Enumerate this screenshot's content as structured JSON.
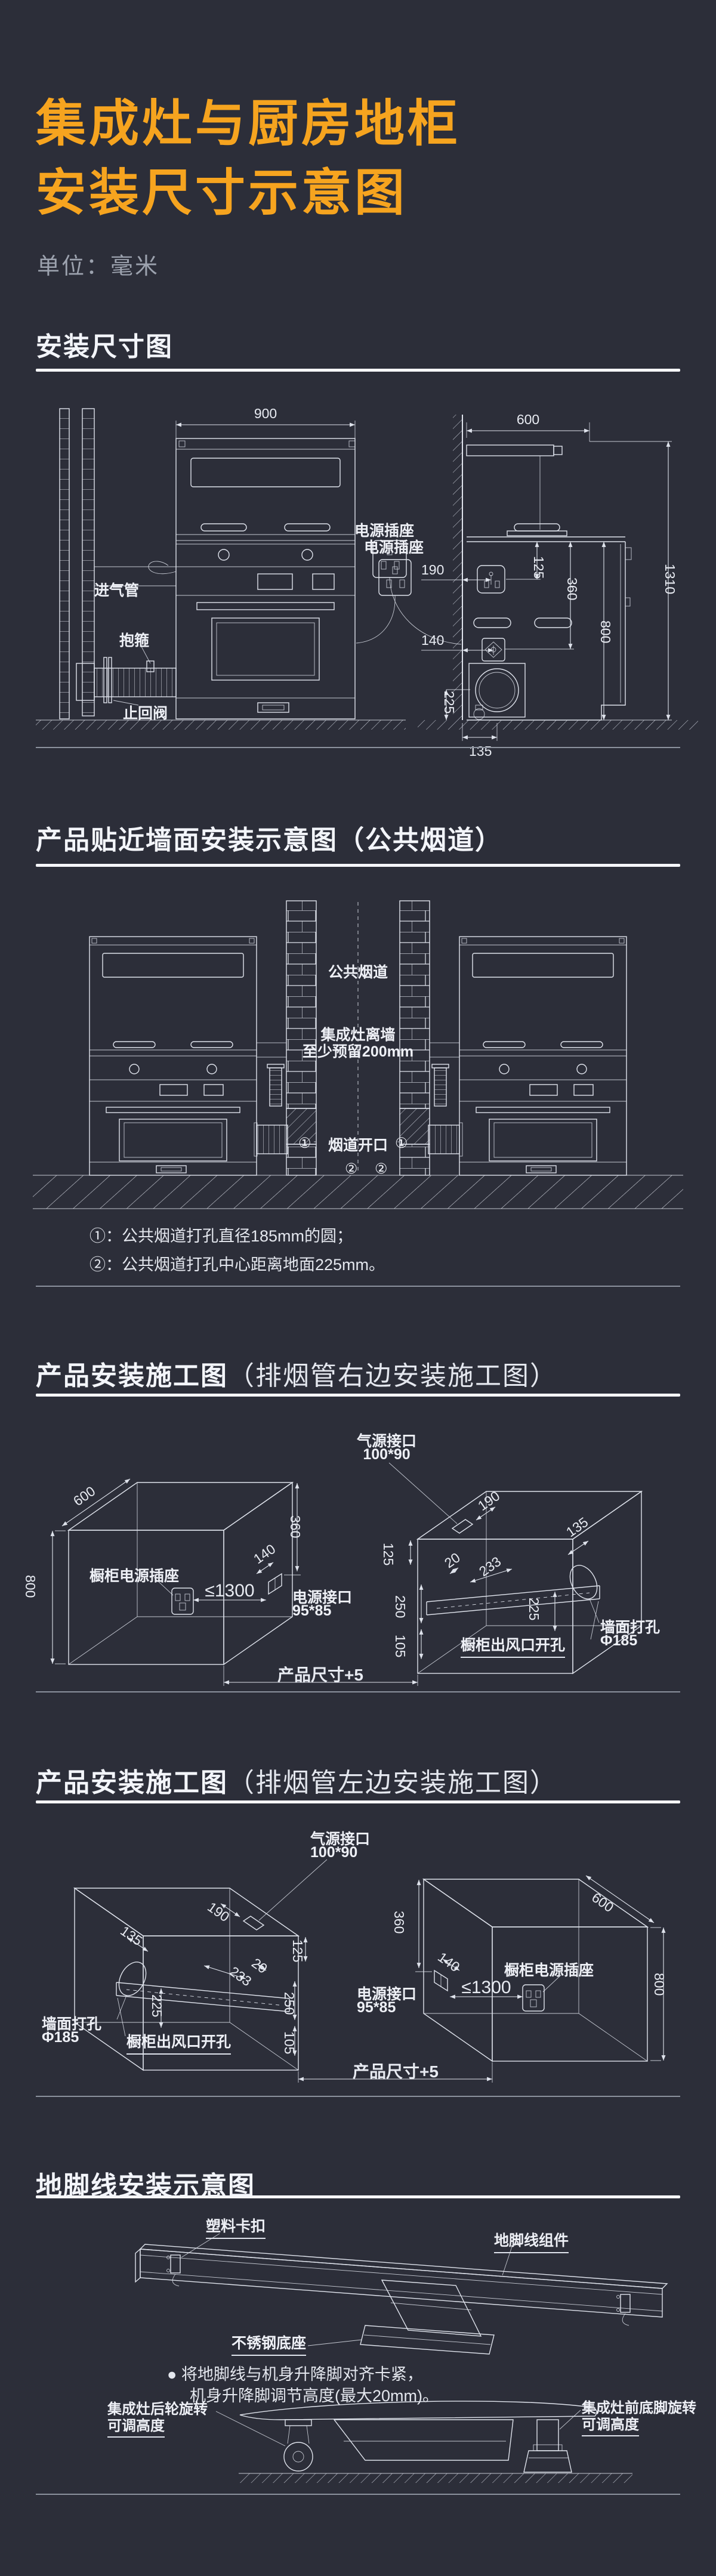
{
  "header": {
    "title_line1": "集成灶与厨房地柜",
    "title_line2": "安装尺寸示意图",
    "unit_note": "单位：毫米"
  },
  "colors": {
    "background": "#2c2e39",
    "accent_orange": "#f6a41f",
    "line": "#dfe3ec"
  },
  "s1": {
    "title": "安装尺寸图",
    "front": {
      "d900": "900",
      "gas_inlet": "进气管",
      "clamp": "抱箍",
      "check_valve": "止回阀",
      "socket": "电源插座"
    },
    "side": {
      "d600": "600",
      "d1310": "1310",
      "d800": "800",
      "d360": "360",
      "d125": "125",
      "d190": "190",
      "d140": "140",
      "d225": "225",
      "d135": "135",
      "socket": "电源插座"
    }
  },
  "s2": {
    "title": "产品贴近墙面安装示意图（公共烟道）",
    "common_flue": "公共烟道",
    "wall_gap_line1": "集成灶离墙",
    "wall_gap_line2": "至少预留200mm",
    "flue_opening": "烟道开口",
    "marker1": "①",
    "marker2": "②",
    "note1": "①：公共烟道打孔直径185mm的圆；",
    "note2": "②：公共烟道打孔中心距离地面225mm。"
  },
  "s3": {
    "title_main": "产品安装施工图",
    "title_sub": "（排烟管右边安装施工图）",
    "d600": "600",
    "d800": "800",
    "d360": "360",
    "d140": "140",
    "d1300": "≤1300",
    "cabinet_socket": "橱柜电源插座",
    "power_port_line1": "电源接口",
    "power_port_line2": "95*85",
    "product_size": "产品尺寸+5",
    "gas_port_line1": "气源接口",
    "gas_port_line2": "100*90",
    "d190": "190",
    "d125": "125",
    "d20": "20",
    "d233": "233",
    "d250": "250",
    "d105": "105",
    "d135": "135",
    "d225": "225",
    "vent_opening": "橱柜出风口开孔",
    "wall_hole_line1": "墙面打孔",
    "wall_hole_line2": "Φ185"
  },
  "s4": {
    "title_main": "产品安装施工图",
    "title_sub": "（排烟管左边安装施工图）",
    "d600": "600",
    "d800": "800",
    "d360": "360",
    "d140": "140",
    "d1300": "≤1300",
    "cabinet_socket": "橱柜电源插座",
    "power_port_line1": "电源接口",
    "power_port_line2": "95*85",
    "product_size": "产品尺寸+5",
    "gas_port_line1": "气源接口",
    "gas_port_line2": "100*90",
    "d190": "190",
    "d125": "125",
    "d20": "20",
    "d233": "233",
    "d250": "250",
    "d105": "105",
    "d135": "135",
    "d225": "225",
    "vent_opening": "橱柜出风口开孔",
    "wall_hole_line1": "墙面打孔",
    "wall_hole_line2": "Φ185"
  },
  "s5": {
    "title": "地脚线安装示意图",
    "plastic_clip": "塑料卡扣",
    "baseboard_assembly": "地脚线组件",
    "steel_base": "不锈钢底座",
    "bullet": "●",
    "note_line1": "将地脚线与机身升降脚对齐卡紧，",
    "note_line2": "机身升降脚调节高度(最大20mm)。",
    "rear_wheel_line1": "集成灶后轮旋转",
    "rear_wheel_line2": "可调高度",
    "front_foot_line1": "集成灶前底脚旋转",
    "front_foot_line2": "可调高度"
  }
}
